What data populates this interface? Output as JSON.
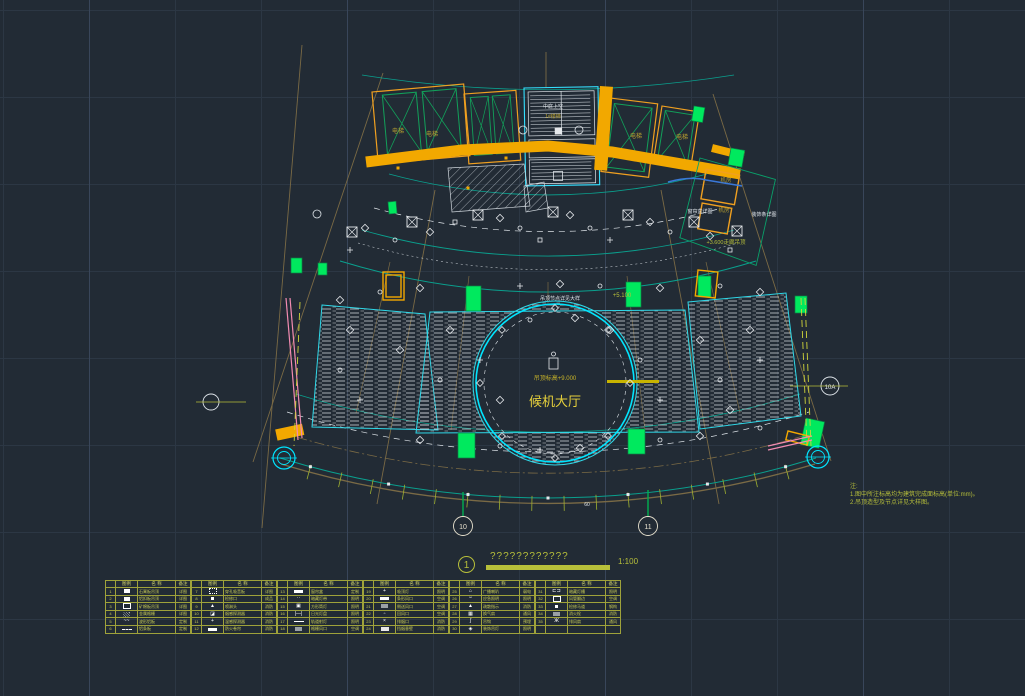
{
  "colors": {
    "background": "#222b35",
    "grid": "#2c3744",
    "cyan": "#00e5ff",
    "teal": "#0aa08e",
    "gold": "#f2a800",
    "olive": "#b7bf3a",
    "green": "#00e95e",
    "dark_green": "#12a05a",
    "pink": "#f28bb1",
    "white": "#e6e9ec",
    "brown": "#7a6a45",
    "blue": "#3a78d8",
    "yellow_text": "#e8d23c"
  },
  "plan": {
    "hall_big": "候机大厅",
    "hall_small": "吊顶标高+9.000",
    "elevator": "电梯",
    "void_label": "中庭上空",
    "stair_label": "1#楼梯",
    "room_label": "机房",
    "level_label": "+5.100",
    "corridor_label": "+3.600走廊吊顶",
    "curtain_label": "窗帘盒详图",
    "strip_label": "装饰条详图",
    "node_label": "吊顶节点详见大样",
    "dim_label": "60"
  },
  "axis": {
    "right_bubble": "10A",
    "bottom_bubble_1": "10",
    "bottom_bubble_2": "11"
  },
  "titleblock": {
    "index": "1",
    "title": "????????????",
    "scale": "1:100"
  },
  "notes": {
    "head": "注:",
    "line1": "1.图中所注标高均为建筑完成面标高(单位:mm)。",
    "line2": "2.吊顶造型及节点详见大样图。"
  },
  "legend": {
    "headers": [
      "",
      "图例",
      "名 称",
      "备注"
    ],
    "items": [
      {
        "no": "1",
        "sym": "f",
        "name": "石膏板吊顶",
        "rk": "详图"
      },
      {
        "no": "2",
        "sym": "f",
        "name": "铝扣板吊顶",
        "rk": "详图"
      },
      {
        "no": "3",
        "sym": "o",
        "name": "矿棉板吊顶",
        "rk": "详图"
      },
      {
        "no": "4",
        "sym": "h",
        "name": "金属格栅",
        "rk": "详图"
      },
      {
        "no": "5",
        "sym": "ch:~~",
        "name": "波形铝板",
        "rk": "定制"
      },
      {
        "no": "6",
        "sym": "dash",
        "name": "铝条板",
        "rk": "定制"
      },
      {
        "no": "7",
        "sym": "dot",
        "name": "穿孔吸音板",
        "rk": "详图"
      },
      {
        "no": "8",
        "sym": "sm",
        "name": "检修口",
        "rk": "成品"
      },
      {
        "no": "9",
        "sym": "ch:▲",
        "name": "喷淋头",
        "rk": "消防"
      },
      {
        "no": "10",
        "sym": "ch:◪",
        "name": "烟感探测器",
        "rk": "消防"
      },
      {
        "no": "11",
        "sym": "ch:+",
        "name": "温感探测器",
        "rk": "消防"
      },
      {
        "no": "12",
        "sym": "bar",
        "name": "防火卷帘",
        "rk": "消防"
      },
      {
        "no": "13",
        "sym": "bar",
        "name": "窗帘盒",
        "rk": "定制"
      },
      {
        "no": "14",
        "sym": "ch:··",
        "name": "暗藏灯带",
        "rk": "照明"
      },
      {
        "no": "15",
        "sym": "ch:▣",
        "name": "方形筒灯",
        "rk": "照明"
      },
      {
        "no": "16",
        "sym": "ch:|—|",
        "name": "日光灯盘",
        "rk": "照明"
      },
      {
        "no": "17",
        "sym": "line",
        "name": "轨道射灯",
        "rk": "照明"
      },
      {
        "no": "18",
        "sym": "g",
        "name": "格栅风口",
        "rk": "空调"
      },
      {
        "no": "19",
        "sym": "ch:+",
        "name": "吸顶灯",
        "rk": "照明"
      },
      {
        "no": "20",
        "sym": "bar",
        "name": "条形风口",
        "rk": "空调"
      },
      {
        "no": "21",
        "sym": "g",
        "name": "侧送风口",
        "rk": "空调"
      },
      {
        "no": "22",
        "sym": "ch:▫",
        "name": "回风口",
        "rk": "空调"
      },
      {
        "no": "23",
        "sym": "ch:×",
        "name": "排烟口",
        "rk": "消防"
      },
      {
        "no": "24",
        "sym": "thick",
        "name": "挡烟垂壁",
        "rk": "消防"
      },
      {
        "no": "25",
        "sym": "ch:⌂",
        "name": "广播喇叭",
        "rk": "弱电"
      },
      {
        "no": "26",
        "sym": "ch:▫▫",
        "name": "应急照明",
        "rk": "照明"
      },
      {
        "no": "27",
        "sym": "ch:▲",
        "name": "疏散指示",
        "rk": "消防"
      },
      {
        "no": "28",
        "sym": "ch:▦",
        "name": "换气扇",
        "rk": "通风"
      },
      {
        "no": "29",
        "sym": "ch:ʃ",
        "name": "吊钩",
        "rk": "预埋"
      },
      {
        "no": "30",
        "sym": "ch:◈",
        "name": "装饰吊灯",
        "rk": "照明"
      },
      {
        "no": "31",
        "sym": "ch:⊏⊐",
        "name": "暗藏灯槽",
        "rk": "照明"
      },
      {
        "no": "32",
        "sym": "o",
        "name": "风管翻边",
        "rk": "空调"
      },
      {
        "no": "33",
        "sym": "sm",
        "name": "检修马道",
        "rk": "钢构"
      },
      {
        "no": "34",
        "sym": "g",
        "name": "消火栓",
        "rk": "消防"
      },
      {
        "no": "35",
        "sym": "ch:Ж",
        "name": "排风扇",
        "rk": "通风"
      }
    ]
  }
}
